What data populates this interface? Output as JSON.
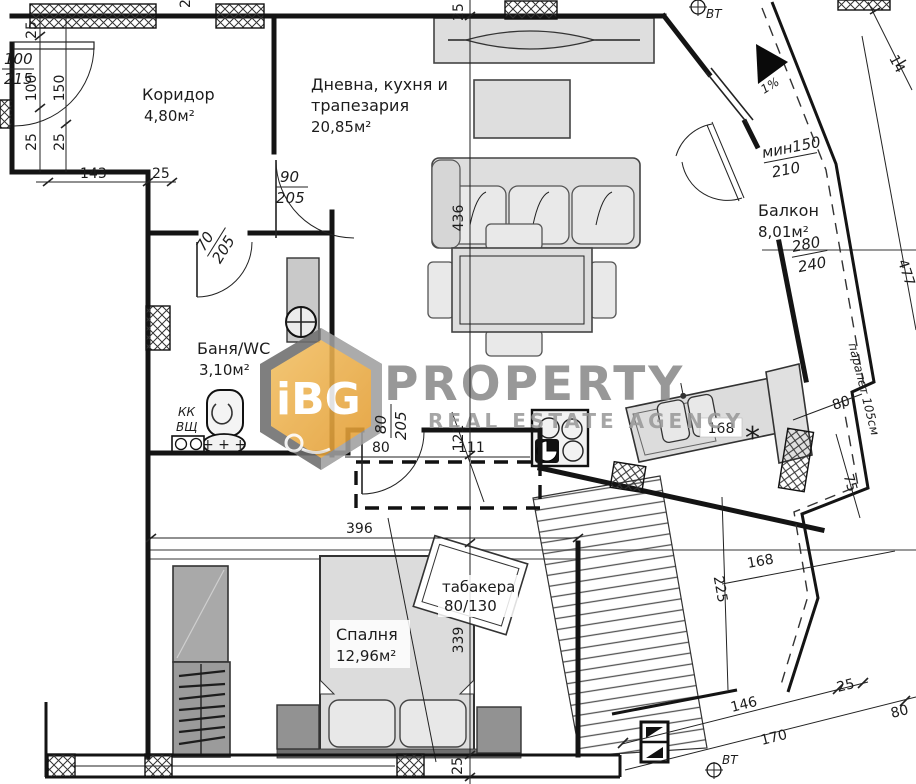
{
  "watermark": {
    "logo": "iBG",
    "title": "PROPERTY",
    "subtitle": "REAL ESTATE AGENCY"
  },
  "rooms": {
    "corridor": {
      "name": "Коридор",
      "area": "4,80м²"
    },
    "living": {
      "line1": "Дневна, кухня и",
      "line2": "трапезария",
      "area": "20,85м²"
    },
    "bath": {
      "name": "Баня/WC",
      "area": "3,10м²"
    },
    "bedroom": {
      "name": "Спалня",
      "area": "12,96м²"
    },
    "balcony": {
      "name": "Балкон",
      "area": "8,01м²"
    },
    "tabakera": {
      "name": "табакера",
      "size": "80/130"
    }
  },
  "doors": {
    "entrance": {
      "num": "100",
      "den": "215"
    },
    "living_door": {
      "num": "90",
      "den": "205"
    },
    "bath_door": {
      "num": "70",
      "den": "205"
    },
    "bedroom_door": {
      "num": "80",
      "den": "205"
    },
    "balcony_door": {
      "num": "280",
      "den": "240"
    },
    "balcony_window": {
      "num": "мин150",
      "den": "210"
    }
  },
  "dims": {
    "v_top25": "25",
    "v_living": "436",
    "v_hall": "121",
    "v_bedroom": "339",
    "v_bottom25": "25",
    "left_25a": "25",
    "left_100": "100",
    "left_25b": "25",
    "left_150": "150",
    "left_25c": "25",
    "corridor_143": "143",
    "corridor_25": "25",
    "top_20": "20",
    "hall_80": "80",
    "hall_111": "111",
    "bedroom_396": "396",
    "kitchen_168": "168",
    "terrace_225": "225",
    "terrace_168": "168",
    "bottom_146": "146",
    "bottom_25": "25",
    "bottom_170": "170",
    "bottom_80": "80",
    "right_80": "80",
    "right_75": "75",
    "balcony_477": "477",
    "top_14": "14"
  },
  "annotations": {
    "vt": "ВТ",
    "slope": "1%",
    "parapet": "парапет 105см",
    "kk": "КК",
    "vshch": "ВЩ",
    "asterisk": "*",
    "mat": "+ + +"
  }
}
